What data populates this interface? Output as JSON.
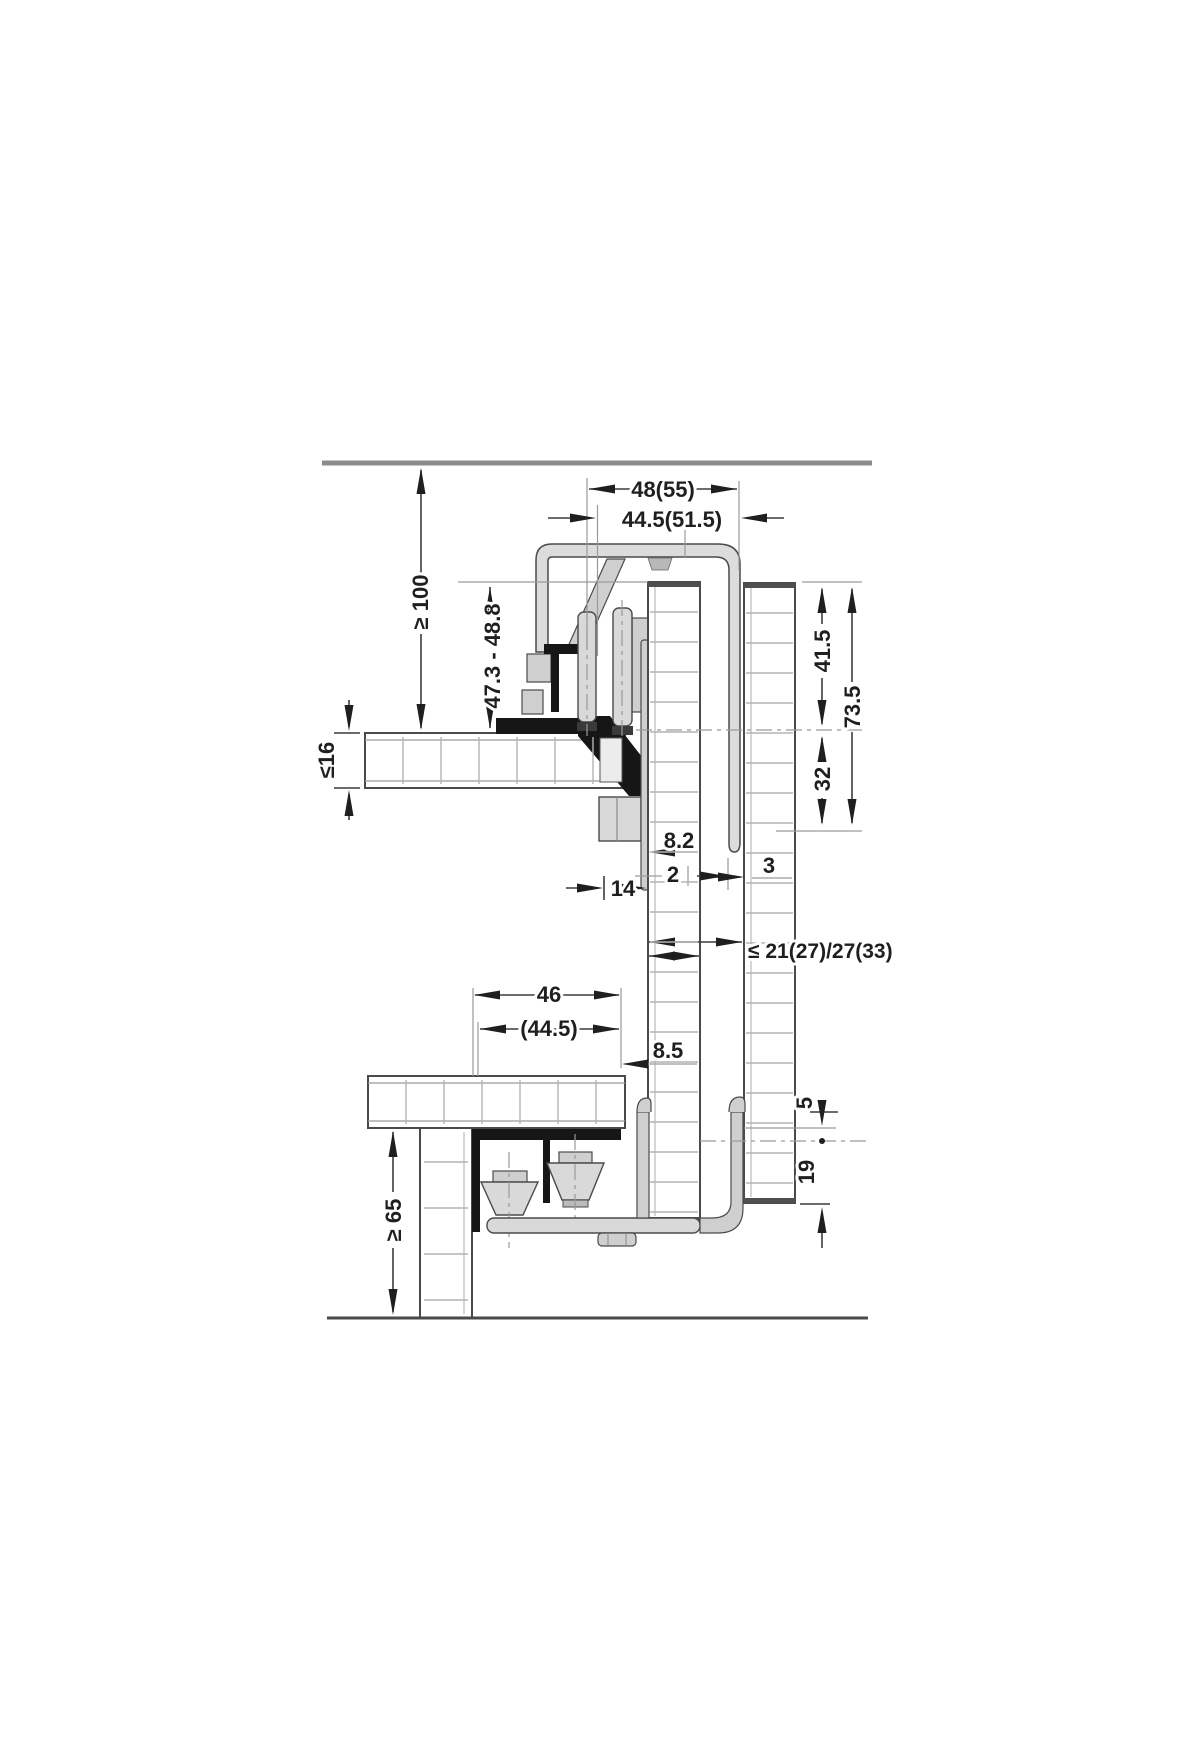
{
  "drawing": {
    "title": "Sliding door fitting installation cross-section",
    "colors": {
      "line": "#4a4a4a",
      "dimension": "#3c3c3c",
      "reference": "#9a9a9a",
      "metal_fill": "#d9d9d9",
      "black_profile": "#161616",
      "hatch": "#b3b3b3",
      "background": "#ffffff"
    },
    "top_section": {
      "dims": {
        "track_width": "48(55)",
        "runner_width": "44.5(51.5)",
        "clearance_above": "≥ 100",
        "door_top_range": "47.3 - 48.8",
        "top_panel_thickness": "≤16",
        "upper_door_engagement": "41.5",
        "overall_profile_height": "73.5",
        "lower_door_engagement": "32",
        "gap_8_2": "8.2",
        "gap_2": "2",
        "gap_3": "3",
        "gap_14": "14",
        "door_distance": "≤ 21(27)/27(33)"
      }
    },
    "bottom_section": {
      "dims": {
        "guide_width": "46",
        "guide_width_alt": "(44.5)",
        "gap_8_5": "8.5",
        "gap_5": "5",
        "bottom_engagement": "19",
        "clearance_below": "≥ 65"
      }
    }
  }
}
